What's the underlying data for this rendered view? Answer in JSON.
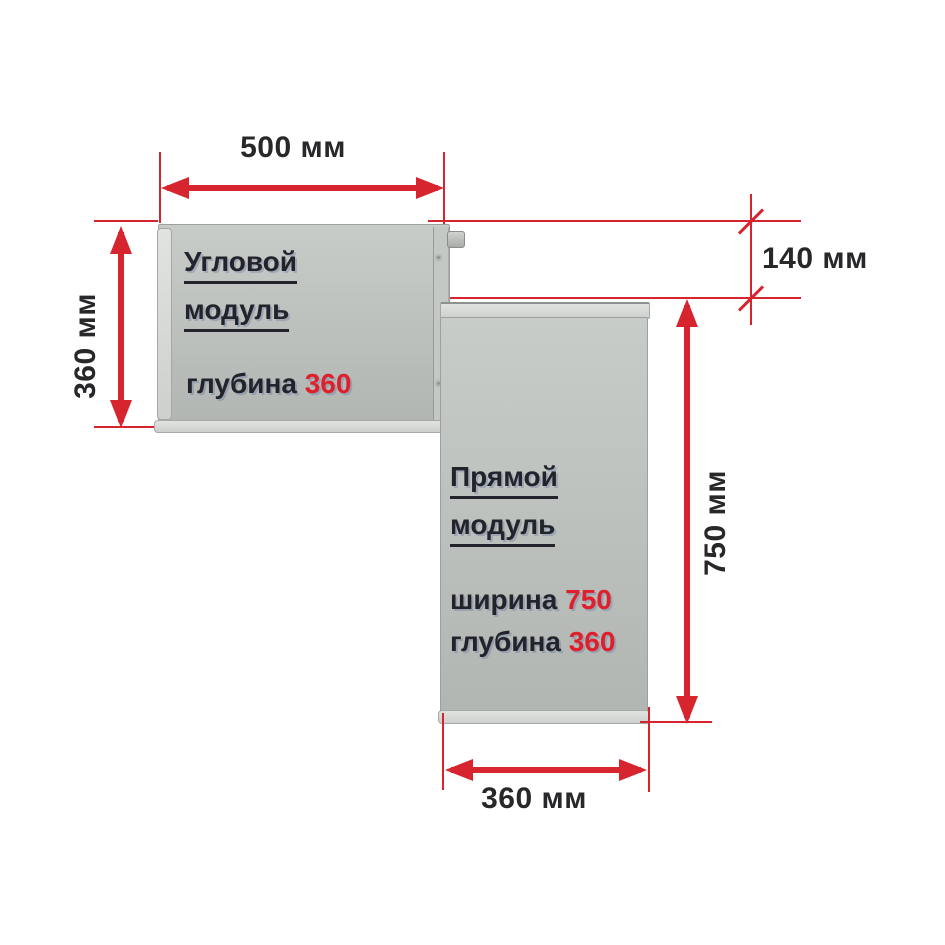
{
  "colors": {
    "dimension_red": "#d6252e",
    "text_dark": "#23242b",
    "value_red": "#e01f2d",
    "panel_gray": "#bcc0bc"
  },
  "dimensions": {
    "top_width": "500 мм",
    "left_height": "360 мм",
    "right_offset": "140 мм",
    "right_height": "750 мм",
    "bottom_width": "360 мм"
  },
  "corner_module": {
    "title_line1": "Угловой",
    "title_line2": "модуль",
    "depth_label": "глубина",
    "depth_value": "360"
  },
  "straight_module": {
    "title_line1": "Прямой",
    "title_line2": "модуль",
    "width_label": "ширина",
    "width_value": "750",
    "depth_label": "глубина",
    "depth_value": "360"
  }
}
